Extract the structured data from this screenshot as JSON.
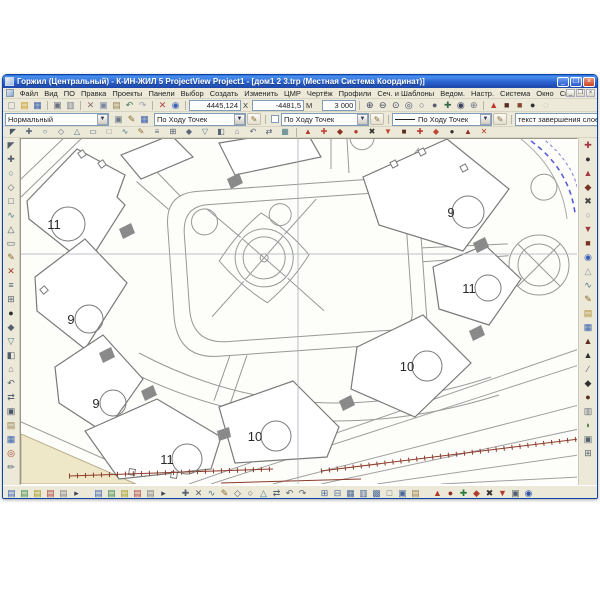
{
  "window": {
    "title": "Горжил (Центральный) - К-ИН-ЖИЛ 5 ProjectView Project1 - [дом1 2 3.trp (Местная Система Координат)]",
    "minimize_label": "_",
    "maximize_label": "❐",
    "close_label": "×"
  },
  "menu": {
    "items": [
      {
        "n": "menu-file",
        "label": "Файл"
      },
      {
        "n": "menu-view",
        "label": "Вид"
      },
      {
        "n": "menu-po",
        "label": "ПО"
      },
      {
        "n": "menu-edit",
        "label": "Правка"
      },
      {
        "n": "menu-projects",
        "label": "Проекты"
      },
      {
        "n": "menu-panels",
        "label": "Панели"
      },
      {
        "n": "menu-select",
        "label": "Выбор"
      },
      {
        "n": "menu-create",
        "label": "Создать"
      },
      {
        "n": "menu-modify",
        "label": "Изменить"
      },
      {
        "n": "menu-cmr",
        "label": "ЦМР"
      },
      {
        "n": "menu-drawing",
        "label": "Чертёж"
      },
      {
        "n": "menu-profiles",
        "label": "Профили"
      },
      {
        "n": "menu-sections",
        "label": "Сеч. и Шаблоны"
      },
      {
        "n": "menu-reports",
        "label": "Ведом."
      },
      {
        "n": "menu-settings",
        "label": "Настр."
      },
      {
        "n": "menu-system",
        "label": "Система"
      },
      {
        "n": "menu-window",
        "label": "Окно"
      },
      {
        "n": "menu-help",
        "label": "Справка"
      }
    ],
    "doc_controls": {
      "min": "_",
      "restore": "❐",
      "close": "×"
    }
  },
  "toolbar_main": {
    "file_icons": [
      {
        "n": "new-file-icon",
        "g": "▢",
        "c": "#8a8fa8"
      },
      {
        "n": "open-file-icon",
        "g": "▤",
        "c": "#c9991c"
      },
      {
        "n": "save-icon",
        "g": "▦",
        "c": "#3a5fb0"
      },
      {
        "sep": true
      },
      {
        "n": "print-icon",
        "g": "▣",
        "c": "#6a7080"
      },
      {
        "n": "print-preview-icon",
        "g": "▥",
        "c": "#7a8090"
      },
      {
        "sep": true
      },
      {
        "n": "cut-icon",
        "g": "✕",
        "c": "#8a6a70"
      },
      {
        "n": "copy-icon",
        "g": "▣",
        "c": "#7a87a0"
      },
      {
        "n": "paste-icon",
        "g": "▤",
        "c": "#97824f"
      },
      {
        "n": "undo-icon",
        "g": "↶",
        "c": "#3f7a4f"
      },
      {
        "n": "redo-icon",
        "g": "↷",
        "c": "#9aa0aa"
      },
      {
        "sep": true
      },
      {
        "n": "delete-icon",
        "g": "✕",
        "c": "#b04040"
      },
      {
        "n": "properties-icon",
        "g": "◉",
        "c": "#3a62b8"
      }
    ],
    "coords": {
      "x_value": "4445,124",
      "x_label": "X",
      "y_value": "-4481,5",
      "y_label": "М",
      "scale_value": "3 000"
    },
    "zoom_icons": [
      {
        "n": "zoom-in-icon",
        "g": "⊕",
        "c": "#3a4260"
      },
      {
        "n": "zoom-out-icon",
        "g": "⊖",
        "c": "#3a4260"
      },
      {
        "n": "zoom-window-icon",
        "g": "⊙",
        "c": "#3a4260"
      },
      {
        "n": "zoom-extents-icon",
        "g": "◎",
        "c": "#3a4260"
      },
      {
        "n": "zoom-previous-icon",
        "g": "○",
        "c": "#555c70"
      },
      {
        "n": "zoom-next-icon",
        "g": "●",
        "c": "#555c70"
      },
      {
        "n": "pan-icon",
        "g": "✚",
        "c": "#3a6a4a"
      },
      {
        "n": "zoom-realtime-icon",
        "g": "◉",
        "c": "#3a4260"
      },
      {
        "n": "fit-view-icon",
        "g": "⊕",
        "c": "#6a7086"
      }
    ],
    "marker_icons": [
      {
        "n": "point-style-icon",
        "g": "▲",
        "c": "#c03a2a"
      },
      {
        "n": "marker-dark-icon",
        "g": "■",
        "c": "#5a2d20"
      },
      {
        "n": "marker-brown-icon",
        "g": "■",
        "c": "#8a4632"
      },
      {
        "n": "node-icon",
        "g": "●",
        "c": "#303030"
      },
      {
        "n": "ghost-point-icon",
        "g": "◌",
        "c": "#99a0aa"
      }
    ]
  },
  "toolbar_styles": {
    "layer_combo": "Нормальный",
    "style_buttons": [
      {
        "n": "style-new-icon",
        "g": "▣",
        "c": "#70788a"
      },
      {
        "n": "style-edit-icon",
        "g": "✎",
        "c": "#8a6a2a"
      },
      {
        "n": "style-save-icon",
        "g": "▦",
        "c": "#3a5fb0"
      }
    ],
    "point_combo": "По Ходу Точек",
    "point_combo_edit_icon": "✎",
    "point_combo2": "По Ходу Точек",
    "point_combo2_edit_icon": "✎",
    "line_combo": "По Ходу Точек",
    "line_combo_edit_icon": "✎",
    "text_combo": "текст завершения слоев",
    "text_combo_icon": "■",
    "dd_glyph": "▼"
  },
  "toolbar_draw": {
    "icons": [
      {
        "n": "select-tool-icon",
        "g": "◤",
        "c": "#4a5468"
      },
      {
        "n": "point-tool-icon",
        "g": "✚",
        "c": "#5a6578"
      },
      {
        "n": "circle-tool-icon",
        "g": "○",
        "c": "#4a7a8a"
      },
      {
        "n": "polygon-tool-icon",
        "g": "◇",
        "c": "#5a6578"
      },
      {
        "n": "triangle-tool-icon",
        "g": "△",
        "c": "#4a7a8a"
      },
      {
        "n": "rect-tool-icon",
        "g": "▭",
        "c": "#5a6578"
      },
      {
        "n": "square-tool-icon",
        "g": "□",
        "c": "#777c88"
      },
      {
        "n": "spline-tool-icon",
        "g": "∿",
        "c": "#4a7a8a"
      },
      {
        "n": "sketch-tool-icon",
        "g": "✎",
        "c": "#8a6a2a"
      },
      {
        "n": "layers-tool-icon",
        "g": "≡",
        "c": "#5a6578"
      },
      {
        "n": "grid-tool-icon",
        "g": "⊞",
        "c": "#4a5468"
      },
      {
        "n": "diamond-tool-icon",
        "g": "◆",
        "c": "#5a6578"
      },
      {
        "n": "down-tool-icon",
        "g": "▽",
        "c": "#4a7a8a"
      },
      {
        "n": "half-square-icon",
        "g": "◧",
        "c": "#5a6578"
      },
      {
        "n": "home-tool-icon",
        "g": "⌂",
        "c": "#777c88"
      },
      {
        "n": "undo-small-icon",
        "g": "↶",
        "c": "#5a6578"
      },
      {
        "n": "swap-tool-icon",
        "g": "⇄",
        "c": "#4a5468"
      },
      {
        "n": "fill-tool-icon",
        "g": "▦",
        "c": "#4a7a8a"
      },
      {
        "sep": true
      },
      {
        "n": "red-flag-icon",
        "g": "▲",
        "c": "#b23a2a"
      },
      {
        "n": "red-cross-icon",
        "g": "✚",
        "c": "#c04432"
      },
      {
        "n": "red-diamond-icon",
        "g": "◆",
        "c": "#8d2f22"
      },
      {
        "n": "red-node-icon",
        "g": "●",
        "c": "#b23a2a"
      },
      {
        "n": "delete-obj-icon",
        "g": "✖",
        "c": "#333333"
      },
      {
        "n": "red-down-icon",
        "g": "▼",
        "c": "#c04432"
      },
      {
        "n": "dark-square-icon",
        "g": "■",
        "c": "#5a2d20"
      },
      {
        "n": "red-plus2-icon",
        "g": "✚",
        "c": "#b23a2a"
      },
      {
        "n": "red-diamond2-icon",
        "g": "◆",
        "c": "#c04432"
      },
      {
        "n": "dark-node-icon",
        "g": "●",
        "c": "#333333"
      },
      {
        "n": "red-up-icon",
        "g": "▲",
        "c": "#8d2f22"
      },
      {
        "n": "cancel-obj-icon",
        "g": "✕",
        "c": "#b23a2a"
      }
    ]
  },
  "left_rail": {
    "icons": [
      {
        "n": "pointer-icon",
        "g": "◤",
        "c": "#55606e"
      },
      {
        "n": "crosshair-icon",
        "g": "✚",
        "c": "#55606e"
      },
      {
        "n": "circle-icon",
        "g": "○",
        "c": "#4a7a8a"
      },
      {
        "n": "diamond-icon",
        "g": "◇",
        "c": "#55606e"
      },
      {
        "n": "square-icon",
        "g": "□",
        "c": "#55606e"
      },
      {
        "n": "spline-icon",
        "g": "∿",
        "c": "#4a7a8a"
      },
      {
        "n": "triangle-icon",
        "g": "△",
        "c": "#55606e"
      },
      {
        "n": "rectangle-icon",
        "g": "▭",
        "c": "#55606e"
      },
      {
        "n": "pencil-icon",
        "g": "✎",
        "c": "#8a6a2a"
      },
      {
        "n": "erase-icon",
        "g": "✕",
        "c": "#a33a2a"
      },
      {
        "n": "layers-icon",
        "g": "≡",
        "c": "#55606e"
      },
      {
        "n": "grid-icon",
        "g": "⊞",
        "c": "#55606e"
      },
      {
        "n": "node-dark-icon",
        "g": "●",
        "c": "#303030"
      },
      {
        "n": "diamond-fill-icon",
        "g": "◆",
        "c": "#55606e"
      },
      {
        "n": "tri-down-icon",
        "g": "▽",
        "c": "#4a7a8a"
      },
      {
        "n": "half-icon",
        "g": "◧",
        "c": "#55606e"
      },
      {
        "n": "home-icon",
        "g": "⌂",
        "c": "#777c88"
      },
      {
        "n": "undo2-icon",
        "g": "↶",
        "c": "#55606e"
      },
      {
        "n": "swap-icon",
        "g": "⇄",
        "c": "#55606e"
      },
      {
        "n": "panel-icon",
        "g": "▣",
        "c": "#4a5468"
      },
      {
        "n": "sheet-icon",
        "g": "▤",
        "c": "#97824f"
      },
      {
        "n": "fill2-icon",
        "g": "▦",
        "c": "#3a5fb0"
      },
      {
        "n": "target-icon",
        "g": "◎",
        "c": "#a33a2a"
      },
      {
        "n": "pen2-icon",
        "g": "✏",
        "c": "#55606e"
      }
    ]
  },
  "right_rail": {
    "icons": [
      {
        "n": "r-plus-icon",
        "g": "✚",
        "c": "#a33844"
      },
      {
        "n": "r-dot-icon",
        "g": "●",
        "c": "#303030"
      },
      {
        "n": "r-tri-icon",
        "g": "▲",
        "c": "#a33844"
      },
      {
        "n": "r-diamond-icon",
        "g": "◆",
        "c": "#7a3226"
      },
      {
        "n": "r-cross-icon",
        "g": "✖",
        "c": "#444444"
      },
      {
        "n": "r-circle-icon",
        "g": "○",
        "c": "#8a8f9a"
      },
      {
        "n": "r-down-icon",
        "g": "▼",
        "c": "#a33844"
      },
      {
        "n": "r-square-icon",
        "g": "■",
        "c": "#7a3226"
      },
      {
        "n": "r-target-icon",
        "g": "◉",
        "c": "#3a62b8"
      },
      {
        "n": "r-tri2-icon",
        "g": "△",
        "c": "#8a8f9a"
      },
      {
        "n": "r-wave-icon",
        "g": "∿",
        "c": "#4a7a8a"
      },
      {
        "n": "r-pen-icon",
        "g": "✎",
        "c": "#8a6a2a"
      },
      {
        "n": "r-chip1-icon",
        "g": "▤",
        "c": "#b08830"
      },
      {
        "n": "r-chip2-icon",
        "g": "▦",
        "c": "#3a5fb0"
      },
      {
        "n": "r-flag-icon",
        "g": "▲",
        "c": "#5a2d20"
      },
      {
        "n": "r-flag2-icon",
        "g": "▲",
        "c": "#303030"
      },
      {
        "n": "r-slash-icon",
        "g": "∕",
        "c": "#555c70"
      },
      {
        "n": "r-fish-icon",
        "g": "◆",
        "c": "#303030"
      },
      {
        "n": "r-blob-icon",
        "g": "●",
        "c": "#5a2d20"
      },
      {
        "n": "r-chip3-icon",
        "g": "▥",
        "c": "#6a7080"
      },
      {
        "n": "r-leaf-icon",
        "g": "◗",
        "c": "#4a7a3a"
      },
      {
        "n": "r-box-icon",
        "g": "▣",
        "c": "#55606e"
      },
      {
        "n": "r-grid-icon",
        "g": "⊞",
        "c": "#55606e"
      }
    ]
  },
  "bottom_bar": {
    "layer_group1": [
      {
        "n": "layer-blue-icon",
        "g": "▤",
        "c": "#3a62b8"
      },
      {
        "n": "layer-green-icon",
        "g": "▤",
        "c": "#3a8a4a"
      },
      {
        "n": "layer-olive-icon",
        "g": "▤",
        "c": "#a09a20"
      },
      {
        "n": "layer-red-icon",
        "g": "▤",
        "c": "#b04040"
      },
      {
        "n": "layer-gray-icon",
        "g": "▤",
        "c": "#808080"
      },
      {
        "n": "layer-expand-icon",
        "g": "▸",
        "c": "#445"
      }
    ],
    "layer_group2": [
      {
        "n": "layer2-blue-icon",
        "g": "▤",
        "c": "#3a62b8"
      },
      {
        "n": "layer2-green-icon",
        "g": "▤",
        "c": "#3a8a4a"
      },
      {
        "n": "layer2-olive-icon",
        "g": "▤",
        "c": "#a09a20"
      },
      {
        "n": "layer2-red-icon",
        "g": "▤",
        "c": "#b04040"
      },
      {
        "n": "layer2-gray-icon",
        "g": "▤",
        "c": "#808080"
      },
      {
        "n": "layer2-expand-icon",
        "g": "▸",
        "c": "#445"
      }
    ],
    "edit_group": [
      {
        "n": "b-plus-icon",
        "g": "✚",
        "c": "#55606e"
      },
      {
        "n": "b-cross-icon",
        "g": "✕",
        "c": "#55606e"
      },
      {
        "n": "b-wave-icon",
        "g": "∿",
        "c": "#4a7a8a"
      },
      {
        "n": "b-pen-icon",
        "g": "✎",
        "c": "#8a6a2a"
      },
      {
        "n": "b-diamond-icon",
        "g": "◇",
        "c": "#55606e"
      },
      {
        "n": "b-circle-icon",
        "g": "○",
        "c": "#55606e"
      },
      {
        "n": "b-tri-icon",
        "g": "△",
        "c": "#4a7a8a"
      },
      {
        "n": "b-swap-icon",
        "g": "⇄",
        "c": "#55606e"
      },
      {
        "n": "b-undo-icon",
        "g": "↶",
        "c": "#55606e"
      },
      {
        "n": "b-redo-icon",
        "g": "↷",
        "c": "#55606e"
      }
    ],
    "table_group": [
      {
        "n": "t-grid1-icon",
        "g": "⊞",
        "c": "#4a6a9a"
      },
      {
        "n": "t-grid2-icon",
        "g": "⊟",
        "c": "#4a6a9a"
      },
      {
        "n": "t-fill-icon",
        "g": "▦",
        "c": "#4a6a9a"
      },
      {
        "n": "t-rows-icon",
        "g": "▥",
        "c": "#4a6a9a"
      },
      {
        "n": "t-hatch-icon",
        "g": "▩",
        "c": "#4a6a9a"
      },
      {
        "n": "t-empty-icon",
        "g": "□",
        "c": "#6a7080"
      },
      {
        "n": "t-box-icon",
        "g": "▣",
        "c": "#4a6a9a"
      },
      {
        "n": "t-sheet-icon",
        "g": "▤",
        "c": "#97824f"
      }
    ],
    "status_group": [
      {
        "n": "s-flag-icon",
        "g": "▲",
        "c": "#b23a2a"
      },
      {
        "n": "s-dot-icon",
        "g": "●",
        "c": "#8d2f22"
      },
      {
        "n": "s-plus-icon",
        "g": "✚",
        "c": "#2a7a3a"
      },
      {
        "n": "s-diamond-icon",
        "g": "◆",
        "c": "#b23a2a"
      },
      {
        "n": "s-cross-icon",
        "g": "✖",
        "c": "#333333"
      },
      {
        "n": "s-down-icon",
        "g": "▼",
        "c": "#b23a2a"
      },
      {
        "n": "s-panel-icon",
        "g": "▣",
        "c": "#55606e"
      },
      {
        "n": "s-target-icon",
        "g": "◉",
        "c": "#2a52a8"
      }
    ]
  },
  "map": {
    "labels": [
      {
        "text": "11"
      },
      {
        "text": "9"
      },
      {
        "text": "11"
      },
      {
        "text": "9"
      },
      {
        "text": "9"
      },
      {
        "text": "10"
      },
      {
        "text": "10"
      },
      {
        "text": "11"
      }
    ],
    "colors": {
      "line": "#8f8f8f",
      "building_stroke": "#7a7a7a",
      "crosshair": "#a8adb5",
      "road_red": "#8d3b2b",
      "arc_blue": "#5b5bd4",
      "corner_fill": "#efe8c8"
    }
  }
}
